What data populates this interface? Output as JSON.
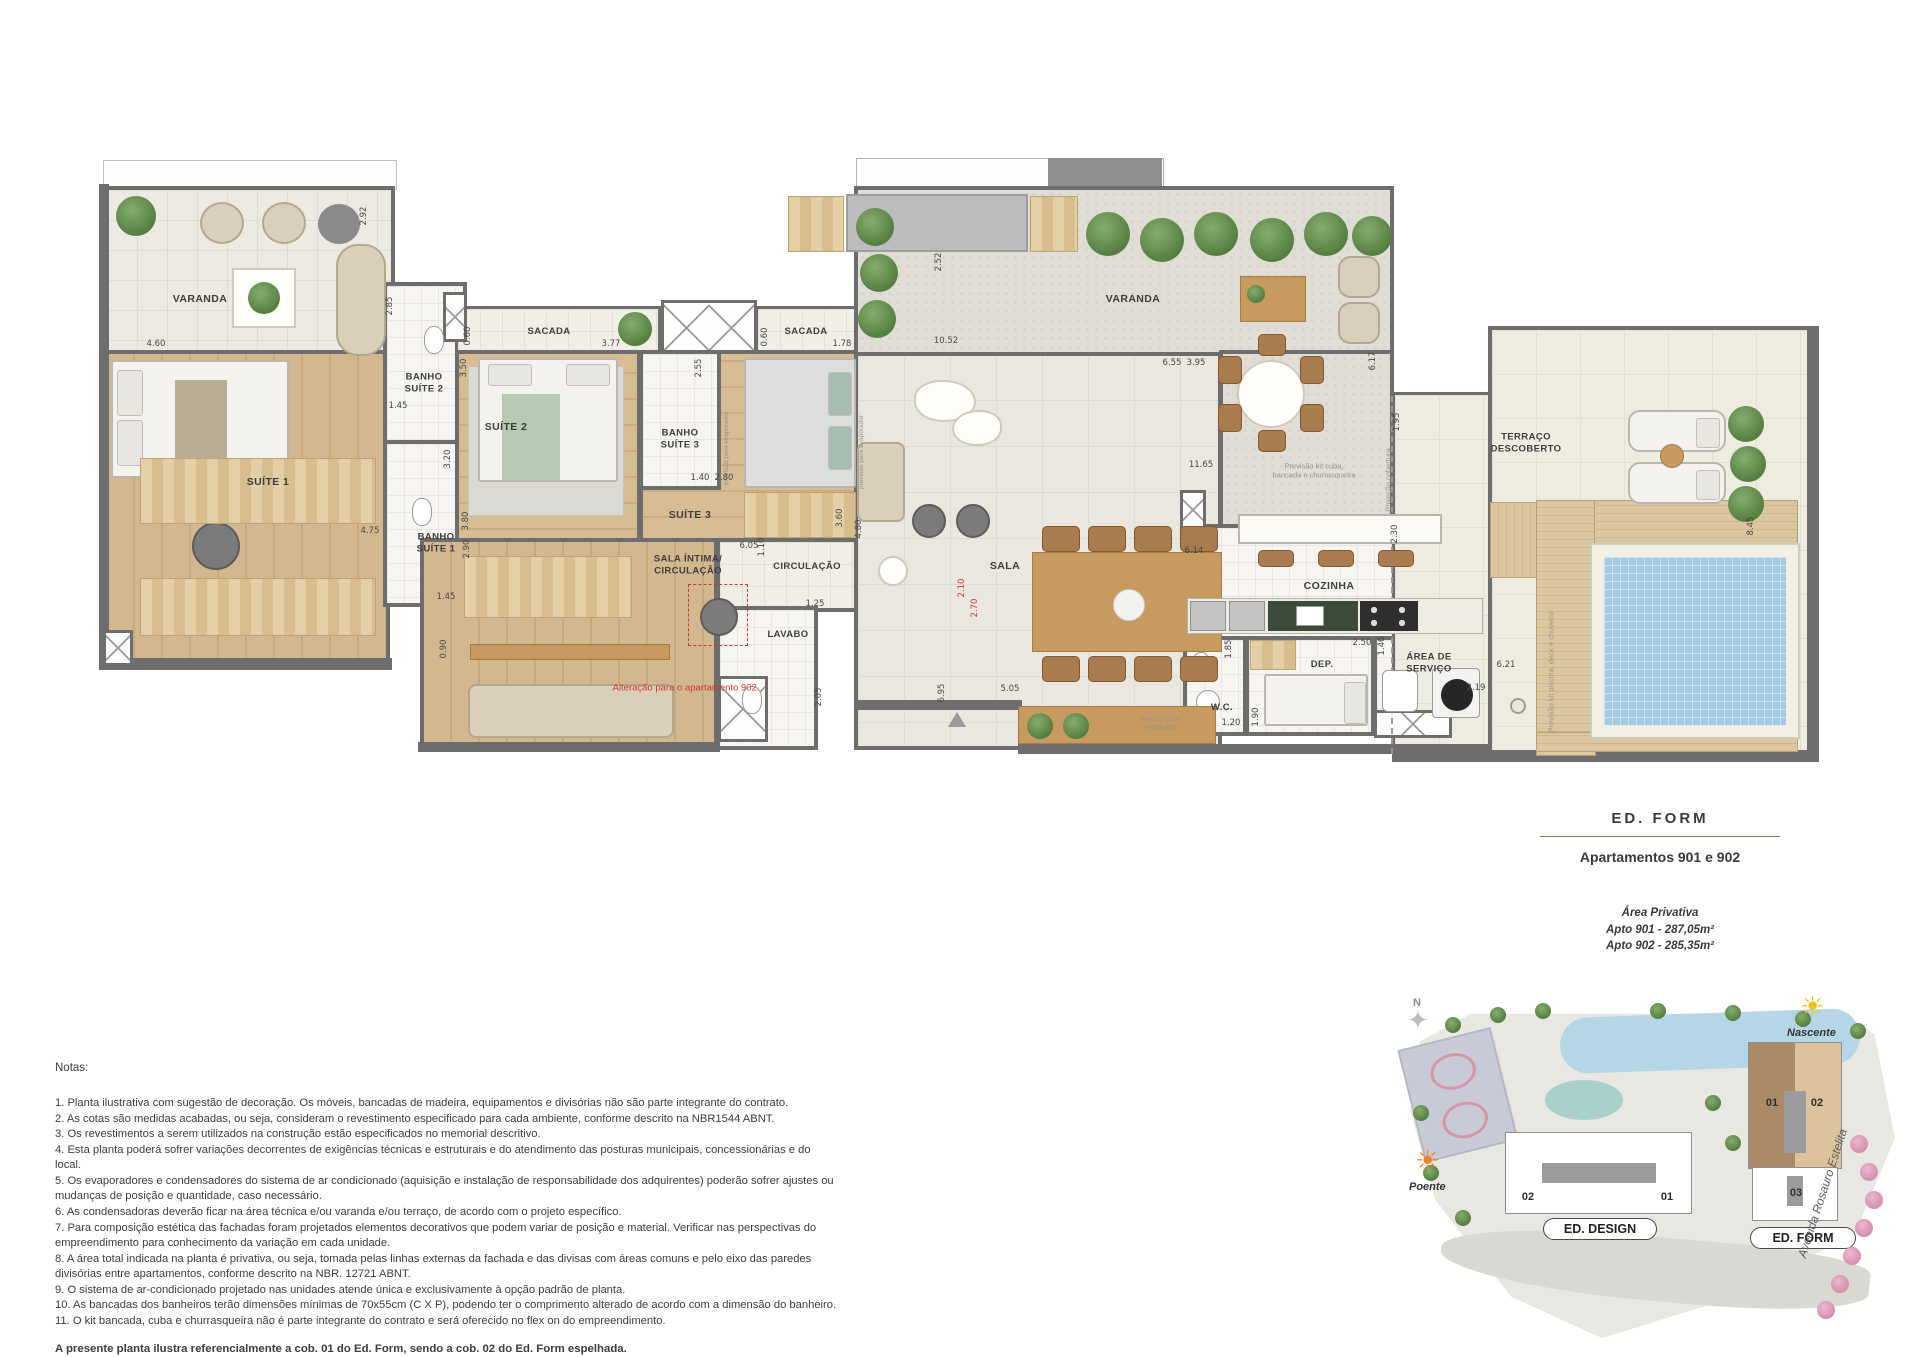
{
  "plan": {
    "rooms": {
      "varanda_left": "VARANDA",
      "suite1": "SUÍTE 1",
      "banho_suite2": "BANHO\nSUÍTE 2",
      "banho_suite1": "BANHO\nSUÍTE 1",
      "sacada1": "SACADA",
      "sacada2": "SACADA",
      "suite2": "SUÍTE 2",
      "banho_suite3": "BANHO\nSUÍTE 3",
      "suite3": "SUÍTE 3",
      "sala_intima": "SALA ÍNTIMA/\nCIRCULAÇÃO",
      "circulacao": "CIRCULAÇÃO",
      "lavabo": "LAVABO",
      "sala": "SALA",
      "varanda_top": "VARANDA",
      "cozinha": "COZINHA",
      "wc": "W.C.",
      "dep": "DEP.",
      "area_servico": "ÁREA DE\nSERVIÇO",
      "terraco": "TERRAÇO\nDESCOBERTO"
    },
    "annotations": {
      "alteracao": "Alteração para o apartamento 902.",
      "kit_cuba": "Previsão kit cuba,\nbancada e churrasqueira",
      "projecao_cobertura": "Projeção cobertura",
      "kit_piscina": "Previsão kit piscina, deck e chuveiro",
      "evaporador": "previsão para evaporador",
      "evaporador2": "previsão para\nevaporador"
    },
    "dims": [
      "4.60",
      "2.92",
      "2.85",
      "1.45",
      "3.50",
      "3.20",
      "4.75",
      "1.45",
      "0.90",
      "3.80",
      "2.90",
      "0.60",
      "3.77",
      "0.60",
      "1.78",
      "2.55",
      "1.40",
      "2.80",
      "3.60",
      "6.05",
      "1.10",
      "1.25",
      "2.05",
      "4.80",
      "5.05",
      "6.95",
      "10.52",
      "2.52",
      "6.55",
      "3.95",
      "6.17",
      "11.65",
      "1.95",
      "6.14",
      "2.30",
      "2.50",
      "1.46",
      "1.85",
      "1.90",
      "1.20",
      "2.19",
      "6.21",
      "8.45"
    ],
    "red_dims": [
      "2.10",
      "2.70"
    ]
  },
  "title_block": {
    "building": "ED.  FORM",
    "subtitle": "Apartamentos 901 e 902",
    "area_heading": "Área Privativa",
    "area_901": "Apto 901 - 287,05m²",
    "area_902": "Apto 902 - 285,35m²"
  },
  "notes": {
    "heading": "Notas:",
    "items": [
      "1. Planta ilustrativa com sugestão de decoração. Os móveis, bancadas de madeira, equipamentos e divisórias não são parte integrante do contrato.",
      "2. As cotas são medidas acabadas, ou seja, consideram o revestimento especificado para cada ambiente, conforme descrito na NBR1544 ABNT.",
      "3. Os revestimentos a serem utilizados na construção estão especificados no memorial descritivo.",
      "4. Esta planta poderá sofrer variações decorrentes de exigências técnicas e estruturais e do atendimento das posturas municipais, concessionárias e do local.",
      "5. Os evaporadores e condensadores do sistema de ar condicionado (aquisição e instalação de responsabilidade dos adquirentes) poderão sofrer ajustes ou mudanças de posição e quantidade, caso necessário.",
      "6. As condensadoras deverão ficar na área técnica e/ou varanda e/ou terraço, de acordo com o projeto específico.",
      "7. Para composição estética das fachadas foram projetados elementos decorativos que podem variar de posição e material. Verificar nas perspectivas do empreendimento para conhecimento da variação em cada unidade.",
      "8. A área total indicada na planta é privativa, ou seja, tomada pelas linhas externas da fachada e das divisas com áreas comuns e pelo eixo das paredes divisórias entre apartamentos, conforme descrito na NBR. 12721 ABNT.",
      "9. O sistema de ar-condicionado projetado nas unidades atende única e exclusivamente à opção padrão de planta.",
      "10. As bancadas dos banheiros terão dimensões mínimas de 70x55cm (C X P), podendo ter o comprimento alterado de acordo com a dimensão do banheiro.",
      "11. O kit bancada, cuba e churrasqueira não é parte integrante do contrato e será oferecido no flex on do empreendimento."
    ],
    "footer": "A presente planta ilustra referencialmente a cob. 01 do Ed. Form, sendo a cob. 02 do Ed. Form espelhada."
  },
  "site_map": {
    "compass": "N",
    "nascente": "Nascente",
    "poente": "Poente",
    "street": "Avenida Rosauro Estelita",
    "ed_design": {
      "name": "ED. DESIGN",
      "unit_left": "02",
      "unit_right": "01"
    },
    "ed_form": {
      "name": "ED. FORM",
      "unit_01": "01",
      "unit_02": "02",
      "unit_03": "03"
    },
    "colors": {
      "form_01": "#ab8a68",
      "form_02": "#dcc29a",
      "accent_red": "#cc3a2e",
      "pool_blue": "#a3c9e3"
    }
  }
}
